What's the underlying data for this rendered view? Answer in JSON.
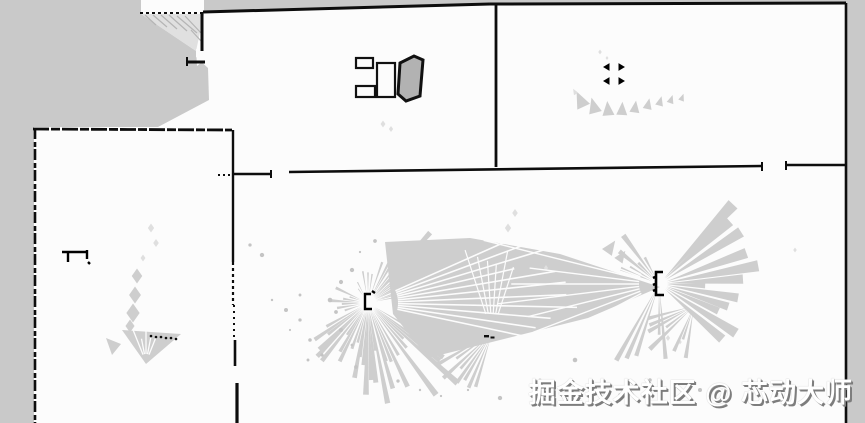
{
  "meta": {
    "title": "SLAM occupancy grid map",
    "type": "occupancy-grid-map"
  },
  "watermark": {
    "text": "掘金技术社区 @ 芯动大师"
  },
  "colors": {
    "free": "#fcfcfc",
    "unknown": "#c9c9c9",
    "wall": "#0d0d0d",
    "scan": "#cecece",
    "scan_light": "#dfdfdf",
    "watermark_fill": "#ffffff",
    "watermark_shadow": "#7d7d7d"
  },
  "map": {
    "width": 865,
    "height": 423,
    "unknown_regions": [
      {
        "name": "unknown-top-left",
        "points": [
          [
            0,
            0
          ],
          [
            141,
            0
          ],
          [
            141,
            14
          ],
          [
            196,
            51
          ],
          [
            196,
            57
          ],
          [
            208,
            68
          ],
          [
            209,
            100
          ],
          [
            158,
            127
          ],
          [
            0,
            127
          ]
        ]
      },
      {
        "name": "unknown-hatch-base",
        "points": [
          [
            141,
            14
          ],
          [
            204,
            14
          ],
          [
            196,
            51
          ]
        ],
        "fill": "#e0e0e0"
      },
      {
        "name": "unknown-left-strip",
        "points": [
          [
            0,
            127
          ],
          [
            34,
            127
          ],
          [
            34,
            423
          ],
          [
            0,
            423
          ]
        ]
      },
      {
        "name": "unknown-top-strip-middle",
        "points": [
          [
            204,
            0
          ],
          [
            496,
            0
          ],
          [
            496,
            4
          ],
          [
            204,
            12
          ]
        ]
      },
      {
        "name": "unknown-top-strip-right",
        "points": [
          [
            496,
            0
          ],
          [
            846,
            0
          ],
          [
            846,
            3
          ],
          [
            496,
            3
          ]
        ]
      },
      {
        "name": "unknown-right-strip",
        "points": [
          [
            846,
            0
          ],
          [
            865,
            0
          ],
          [
            865,
            423
          ],
          [
            846,
            423
          ]
        ]
      },
      {
        "name": "doorway-notch",
        "points": [
          [
            196,
            49
          ],
          [
            208,
            57
          ],
          [
            197,
            66
          ]
        ],
        "fill": "#fcfcfc"
      }
    ],
    "hatch_lines": [
      [
        145,
        15,
        156,
        25
      ],
      [
        153,
        15,
        167,
        27
      ],
      [
        161,
        15,
        177,
        29
      ],
      [
        169,
        15,
        187,
        31
      ],
      [
        177,
        16,
        197,
        33
      ],
      [
        185,
        16,
        202,
        34
      ],
      [
        191,
        30,
        201,
        41
      ]
    ],
    "wedges": [
      {
        "name": "central-scan-wedge",
        "points": [
          [
            385,
            242
          ],
          [
            470,
            238
          ],
          [
            560,
            254
          ],
          [
            660,
            287
          ],
          [
            588,
            318
          ],
          [
            480,
            345
          ],
          [
            428,
            358
          ],
          [
            393,
            314
          ]
        ]
      },
      {
        "name": "left-room-scan-wedge",
        "points": [
          [
            122,
            330
          ],
          [
            181,
            334
          ],
          [
            146,
            364
          ]
        ]
      },
      {
        "name": "left-room-scan-tri",
        "points": [
          [
            106,
            338
          ],
          [
            121,
            344
          ],
          [
            112,
            355
          ]
        ]
      }
    ],
    "petals": [
      {
        "x": 137,
        "y": 276,
        "s": 15,
        "shape": "dia"
      },
      {
        "x": 135,
        "y": 295,
        "s": 17,
        "shape": "dia"
      },
      {
        "x": 133,
        "y": 313,
        "s": 19,
        "shape": "dia"
      },
      {
        "x": 130,
        "y": 326,
        "s": 13,
        "shape": "dia"
      },
      {
        "x": 151,
        "y": 228,
        "s": 9,
        "shape": "dia",
        "light": true
      },
      {
        "x": 156,
        "y": 243,
        "s": 8,
        "shape": "dia",
        "light": true
      },
      {
        "x": 143,
        "y": 258,
        "s": 7,
        "shape": "dia",
        "light": true
      },
      {
        "x": 581,
        "y": 101,
        "s": 14,
        "shape": "tri",
        "rot": -25
      },
      {
        "x": 594,
        "y": 107,
        "s": 13,
        "shape": "tri",
        "rot": -15
      },
      {
        "x": 608,
        "y": 110,
        "s": 12,
        "shape": "tri",
        "rot": -5
      },
      {
        "x": 622,
        "y": 110,
        "s": 11,
        "shape": "tri",
        "rot": 3
      },
      {
        "x": 635,
        "y": 108,
        "s": 10,
        "shape": "tri",
        "rot": 8
      },
      {
        "x": 648,
        "y": 105,
        "s": 9,
        "shape": "tri",
        "rot": 12
      },
      {
        "x": 660,
        "y": 102,
        "s": 8,
        "shape": "tri",
        "rot": 15
      },
      {
        "x": 671,
        "y": 100,
        "s": 7,
        "shape": "tri",
        "rot": 18
      },
      {
        "x": 682,
        "y": 98,
        "s": 6,
        "shape": "tri",
        "rot": 20
      },
      {
        "x": 575,
        "y": 92,
        "s": 5,
        "shape": "tri",
        "rot": -30,
        "light": true
      },
      {
        "x": 600,
        "y": 52,
        "s": 5,
        "shape": "dia",
        "light": true
      },
      {
        "x": 607,
        "y": 58,
        "s": 4,
        "shape": "dia",
        "light": true
      },
      {
        "x": 383,
        "y": 124,
        "s": 7,
        "shape": "dia",
        "light": true
      },
      {
        "x": 391,
        "y": 129,
        "s": 6,
        "shape": "dia",
        "light": true
      },
      {
        "x": 508,
        "y": 228,
        "s": 9,
        "shape": "dia",
        "light": true
      },
      {
        "x": 515,
        "y": 213,
        "s": 8,
        "shape": "dia",
        "light": true
      },
      {
        "x": 546,
        "y": 268,
        "s": 6,
        "shape": "dia",
        "light": true
      },
      {
        "x": 610,
        "y": 248,
        "s": 12,
        "shape": "tri",
        "rot": 35
      },
      {
        "x": 621,
        "y": 257,
        "s": 10,
        "shape": "tri",
        "rot": 35
      },
      {
        "x": 795,
        "y": 250,
        "s": 5,
        "shape": "dia",
        "light": true
      },
      {
        "x": 668,
        "y": 338,
        "s": 6,
        "shape": "dia",
        "light": true
      },
      {
        "x": 680,
        "y": 342,
        "s": 5,
        "shape": "dia",
        "light": true
      }
    ],
    "fans": [
      {
        "name": "lidar-fan-left",
        "cx": 368,
        "cy": 303,
        "r0": 8,
        "bundles": [
          {
            "a0": -62,
            "a1": -8,
            "n": 14,
            "rmin": 30,
            "rmax": 95,
            "hw": 1.6,
            "seed": 1
          },
          {
            "a0": 30,
            "a1": 78,
            "n": 16,
            "rmin": 50,
            "rmax": 125,
            "hw": 1.5,
            "seed": 2
          },
          {
            "a0": 80,
            "a1": 112,
            "n": 10,
            "rmin": 40,
            "rmax": 95,
            "hw": 1.8,
            "seed": 3
          },
          {
            "a0": 115,
            "a1": 155,
            "n": 10,
            "rmin": 30,
            "rmax": 75,
            "hw": 1.8,
            "seed": 4
          },
          {
            "a0": 163,
            "a1": 205,
            "n": 7,
            "rmin": 15,
            "rmax": 42,
            "hw": 2.4,
            "seed": 5
          },
          {
            "a0": 235,
            "a1": 288,
            "n": 7,
            "rmin": 14,
            "rmax": 45,
            "hw": 1.5,
            "seed": 6
          }
        ]
      },
      {
        "name": "lidar-fan-right",
        "cx": 659,
        "cy": 284,
        "r0": 8,
        "bundles": [
          {
            "a0": -48,
            "a1": 40,
            "n": 13,
            "rmin": 45,
            "rmax": 115,
            "hw": 3.2,
            "seed": 7
          },
          {
            "a0": 195,
            "a1": 250,
            "n": 8,
            "rmin": 28,
            "rmax": 72,
            "hw": 2.6,
            "seed": 8
          },
          {
            "a0": 85,
            "a1": 120,
            "n": 7,
            "rmin": 50,
            "rmax": 100,
            "hw": 1.6,
            "seed": 9
          }
        ]
      },
      {
        "name": "lidar-fan-lower-right",
        "cx": 694,
        "cy": 306,
        "r0": 6,
        "bundles": [
          {
            "a0": 100,
            "a1": 165,
            "n": 10,
            "rmin": 25,
            "rmax": 68,
            "hw": 2.2,
            "seed": 10
          }
        ]
      },
      {
        "name": "lidar-fan-center",
        "cx": 492,
        "cy": 333,
        "r0": 6,
        "bundles": [
          {
            "a0": 240,
            "a1": 300,
            "n": 9,
            "rmin": 45,
            "rmax": 95,
            "hw": 3.4,
            "seed": 11
          },
          {
            "a0": 95,
            "a1": 150,
            "n": 10,
            "rmin": 30,
            "rmax": 70,
            "hw": 1.8,
            "seed": 12
          },
          {
            "a0": 205,
            "a1": 235,
            "n": 4,
            "rmin": 18,
            "rmax": 45,
            "hw": 2.0,
            "seed": 13
          }
        ]
      }
    ],
    "white_rays": [
      {
        "cx": 368,
        "cy": 303,
        "a0": -24,
        "a1": 12,
        "n": 11,
        "rmin": 30,
        "rmax": 230,
        "w": 1.6,
        "seed": 21
      },
      {
        "cx": 659,
        "cy": 284,
        "a0": 152,
        "a1": 208,
        "n": 9,
        "rmin": 20,
        "rmax": 190,
        "w": 1.4,
        "seed": 22
      },
      {
        "cx": 146,
        "cy": 362,
        "a0": 248,
        "a1": 292,
        "n": 5,
        "rmin": 8,
        "rmax": 34,
        "w": 1.3,
        "seed": 23
      },
      {
        "cx": 492,
        "cy": 333,
        "a0": 252,
        "a1": 288,
        "n": 6,
        "rmin": 20,
        "rmax": 95,
        "w": 1.2,
        "seed": 24
      }
    ],
    "speckles": [
      [
        330,
        300
      ],
      [
        336,
        312
      ],
      [
        341,
        330
      ],
      [
        352,
        345
      ],
      [
        300,
        320
      ],
      [
        310,
        340
      ],
      [
        322,
        355
      ],
      [
        356,
        367
      ],
      [
        398,
        381
      ],
      [
        420,
        390
      ],
      [
        441,
        396
      ],
      [
        300,
        295
      ],
      [
        286,
        310
      ],
      [
        272,
        300
      ],
      [
        290,
        330
      ],
      [
        308,
        360
      ],
      [
        352,
        270
      ],
      [
        341,
        282
      ],
      [
        360,
        252
      ],
      [
        375,
        241
      ],
      [
        468,
        390
      ],
      [
        500,
        398
      ],
      [
        540,
        380
      ],
      [
        575,
        360
      ],
      [
        620,
        395
      ],
      [
        650,
        380
      ],
      [
        700,
        390
      ],
      [
        250,
        245
      ],
      [
        262,
        255
      ]
    ],
    "black_marks": [
      {
        "name": "scan-hit-dash-1",
        "x": 484,
        "y": 335,
        "w": 5,
        "h": 2.4
      },
      {
        "name": "scan-hit-dash-2",
        "x": 490.5,
        "y": 336.5,
        "w": 4,
        "h": 2
      },
      {
        "name": "table-block-1-infill",
        "x": 359,
        "y": 61.5,
        "w": 10,
        "h": 2.6
      },
      {
        "name": "table-block-2-infill",
        "x": 359,
        "y": 89.5,
        "w": 11,
        "h": 2.6
      }
    ],
    "black_dots": [
      [
        151,
        336
      ],
      [
        156,
        337
      ],
      [
        161,
        337
      ],
      [
        166,
        338
      ],
      [
        171,
        338
      ],
      [
        176,
        339
      ]
    ],
    "walls": [
      {
        "name": "top-wall-dotted",
        "x1": 140,
        "y1": 13,
        "x2": 204,
        "y2": 13,
        "w": 2,
        "dash": "3 3"
      },
      {
        "name": "upper-left-partition",
        "x1": 202,
        "y1": 12,
        "x2": 202,
        "y2": 51,
        "w": 3
      },
      {
        "name": "partition-jog",
        "x1": 186,
        "y1": 62,
        "x2": 205,
        "y2": 62,
        "w": 3
      },
      {
        "name": "partition-jog-tick",
        "x1": 187,
        "y1": 57,
        "x2": 187,
        "y2": 66,
        "w": 2
      },
      {
        "name": "top-wall-middle",
        "x1": 203,
        "y1": 12,
        "x2": 490,
        "y2": 4,
        "w": 3
      },
      {
        "name": "top-wall-right",
        "x1": 490,
        "y1": 4,
        "x2": 846,
        "y2": 3,
        "w": 3
      },
      {
        "name": "right-wall",
        "x1": 846,
        "y1": 3,
        "x2": 846,
        "y2": 423,
        "w": 2.6
      },
      {
        "name": "middle-room-divider",
        "x1": 496,
        "y1": 5,
        "x2": 496,
        "y2": 167,
        "w": 2.8
      },
      {
        "name": "hall-top-wall",
        "x1": 289,
        "y1": 172,
        "x2": 762,
        "y2": 166,
        "w": 2.6
      },
      {
        "name": "hall-top-wall-tick-left",
        "x1": 762,
        "y1": 162,
        "x2": 762,
        "y2": 171,
        "w": 2
      },
      {
        "name": "hall-top-wall-right",
        "x1": 786,
        "y1": 165,
        "x2": 846,
        "y2": 165,
        "w": 2.4
      },
      {
        "name": "hall-top-wall-tick-right",
        "x1": 786,
        "y1": 161,
        "x2": 786,
        "y2": 170,
        "w": 2
      },
      {
        "name": "corridor-stub-wall",
        "x1": 232,
        "y1": 174,
        "x2": 271,
        "y2": 174,
        "w": 2.4
      },
      {
        "name": "corridor-stub-tick",
        "x1": 271,
        "y1": 170,
        "x2": 271,
        "y2": 178,
        "w": 2
      },
      {
        "name": "corridor-stub-dots",
        "x1": 218,
        "y1": 175,
        "x2": 232,
        "y2": 175,
        "w": 2,
        "dash": "2 3"
      },
      {
        "name": "left-room-top-wall",
        "x1": 33,
        "y1": 129,
        "x2": 232,
        "y2": 130,
        "w": 2.8,
        "dash": "16 2 9 2"
      },
      {
        "name": "left-room-left-wall",
        "x1": 35,
        "y1": 128,
        "x2": 35,
        "y2": 423,
        "w": 2.6,
        "dash": "11 3 5 2"
      },
      {
        "name": "left-room-right-wall-a",
        "x1": 233,
        "y1": 130,
        "x2": 233,
        "y2": 262,
        "w": 2.4
      },
      {
        "name": "left-room-right-wall-b",
        "x1": 233,
        "y1": 262,
        "x2": 233,
        "y2": 305,
        "w": 2.2,
        "dash": "3 3"
      },
      {
        "name": "left-room-right-wall-c",
        "x1": 234,
        "y1": 305,
        "x2": 234,
        "y2": 340,
        "w": 2,
        "dash": "2 4"
      },
      {
        "name": "left-room-right-wall-d",
        "x1": 235,
        "y1": 340,
        "x2": 235,
        "y2": 366,
        "w": 2.6
      },
      {
        "name": "left-room-right-wall-e",
        "x1": 237,
        "y1": 383,
        "x2": 237,
        "y2": 423,
        "w": 3.2
      }
    ],
    "object_rects": [
      {
        "name": "table-block-1",
        "x": 356,
        "y": 58,
        "w": 17,
        "h": 10
      },
      {
        "name": "table-block-2",
        "x": 356,
        "y": 86,
        "w": 19,
        "h": 11
      },
      {
        "name": "cabinet-outline",
        "x": 377,
        "y": 63,
        "w": 18,
        "h": 34
      }
    ],
    "object_polys": [
      {
        "name": "tilted-object",
        "points": [
          [
            400,
            63
          ],
          [
            414,
            56
          ],
          [
            423,
            60
          ],
          [
            420,
            96
          ],
          [
            406,
            101
          ],
          [
            398,
            94
          ]
        ],
        "fill": "#b2b2b2",
        "stroke": "#111111",
        "w": 3
      }
    ],
    "object_paths": [
      {
        "name": "scan-marker-left",
        "d": "M371,294 h-6 v15 h7 M372,291 l3,2",
        "w": 2.4
      },
      {
        "name": "scan-marker-right",
        "d": "M663,272 h-7 v23 h8 M655,277 l-2,1 M655,284 l-2,1 M655,290 l-2,1",
        "w": 2.6
      },
      {
        "name": "left-room-object",
        "d": "M62,252 h26 M68,252 v10 M87,250 v9 M88,262 l2,2",
        "w": 2.4
      },
      {
        "name": "corner-mark-tl",
        "d": "M609,64 v6 l-5,-3 z",
        "w": 1,
        "fill": "#000000"
      },
      {
        "name": "corner-mark-tr",
        "d": "M619,64 v6 l5,-3 z",
        "w": 1,
        "fill": "#000000"
      },
      {
        "name": "corner-mark-bl",
        "d": "M609,78 v6 l-5,-3 z",
        "w": 1,
        "fill": "#000000"
      },
      {
        "name": "corner-mark-br",
        "d": "M619,78 v6 l5,-3 z",
        "w": 1,
        "fill": "#000000"
      }
    ]
  }
}
